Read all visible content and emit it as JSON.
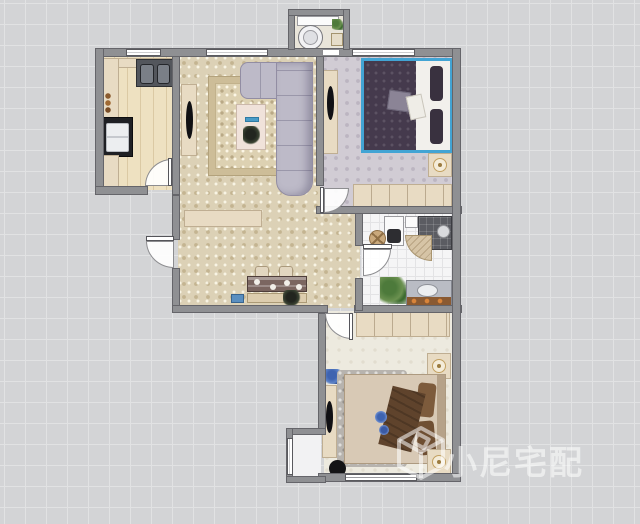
{
  "watermark": {
    "text": "小尼宅配",
    "logo": "cube-logo",
    "color": "rgba(255,255,255,0.55)"
  },
  "canvas": {
    "background_color": "#d3d4d6",
    "grid_line_color": "#e1e2e3",
    "grid_cell_px": 21,
    "wall_color": "#8f9093",
    "selection_color": "#42a4d4"
  },
  "floorplan": {
    "rooms": [
      {
        "id": "balcony-laundry",
        "floor_color": "#e9e5da",
        "items": [
          "laundry-counter",
          "washing-machine",
          "plant-small",
          "storage-box"
        ]
      },
      {
        "id": "kitchen",
        "floor_color": "#eee1c1",
        "items": [
          "counter-top",
          "counter-left",
          "double-sink",
          "stove",
          "counter-bottom",
          "bottles"
        ]
      },
      {
        "id": "living-dining-room",
        "floor_color": "#dcd1b6",
        "items": [
          "tv-cabinet",
          "tv",
          "area-rug",
          "coffee-table",
          "remote",
          "table-plant",
          "corner-sofa",
          "sideboard",
          "dining-table",
          "dining-chair",
          "dining-chair",
          "dining-bench",
          "storage-box",
          "floor-plant"
        ]
      },
      {
        "id": "master-bedroom",
        "floor_color": "#d1ccd4",
        "selected_item": "double-bed",
        "items": [
          "tv-shelf",
          "tv",
          "double-bed",
          "duvet",
          "pillows",
          "nightstand",
          "table-lamp",
          "wardrobe"
        ]
      },
      {
        "id": "bathroom",
        "floor_color": "#f5f5f6",
        "items": [
          "toilet",
          "laundry-basket",
          "wall-cabinet",
          "shower",
          "shower-curtain",
          "plant",
          "vanity-sink"
        ]
      },
      {
        "id": "second-bedroom",
        "floor_color": "#edeadf",
        "items": [
          "wardrobe",
          "nightstand",
          "table-lamp",
          "clothes-pile",
          "shag-rug",
          "double-bed",
          "throw-blanket",
          "pillows",
          "tv-cabinet",
          "tv",
          "stool",
          "nightstand",
          "table-lamp",
          "bay-window-seat"
        ]
      }
    ],
    "doors": [
      "kitchen-door",
      "entry-door",
      "master-bedroom-door",
      "bathroom-door",
      "second-bedroom-door",
      "balcony-threshold"
    ],
    "windows": [
      "kitchen-window",
      "living-room-window",
      "master-bedroom-window",
      "second-bedroom-window",
      "bay-window"
    ]
  }
}
